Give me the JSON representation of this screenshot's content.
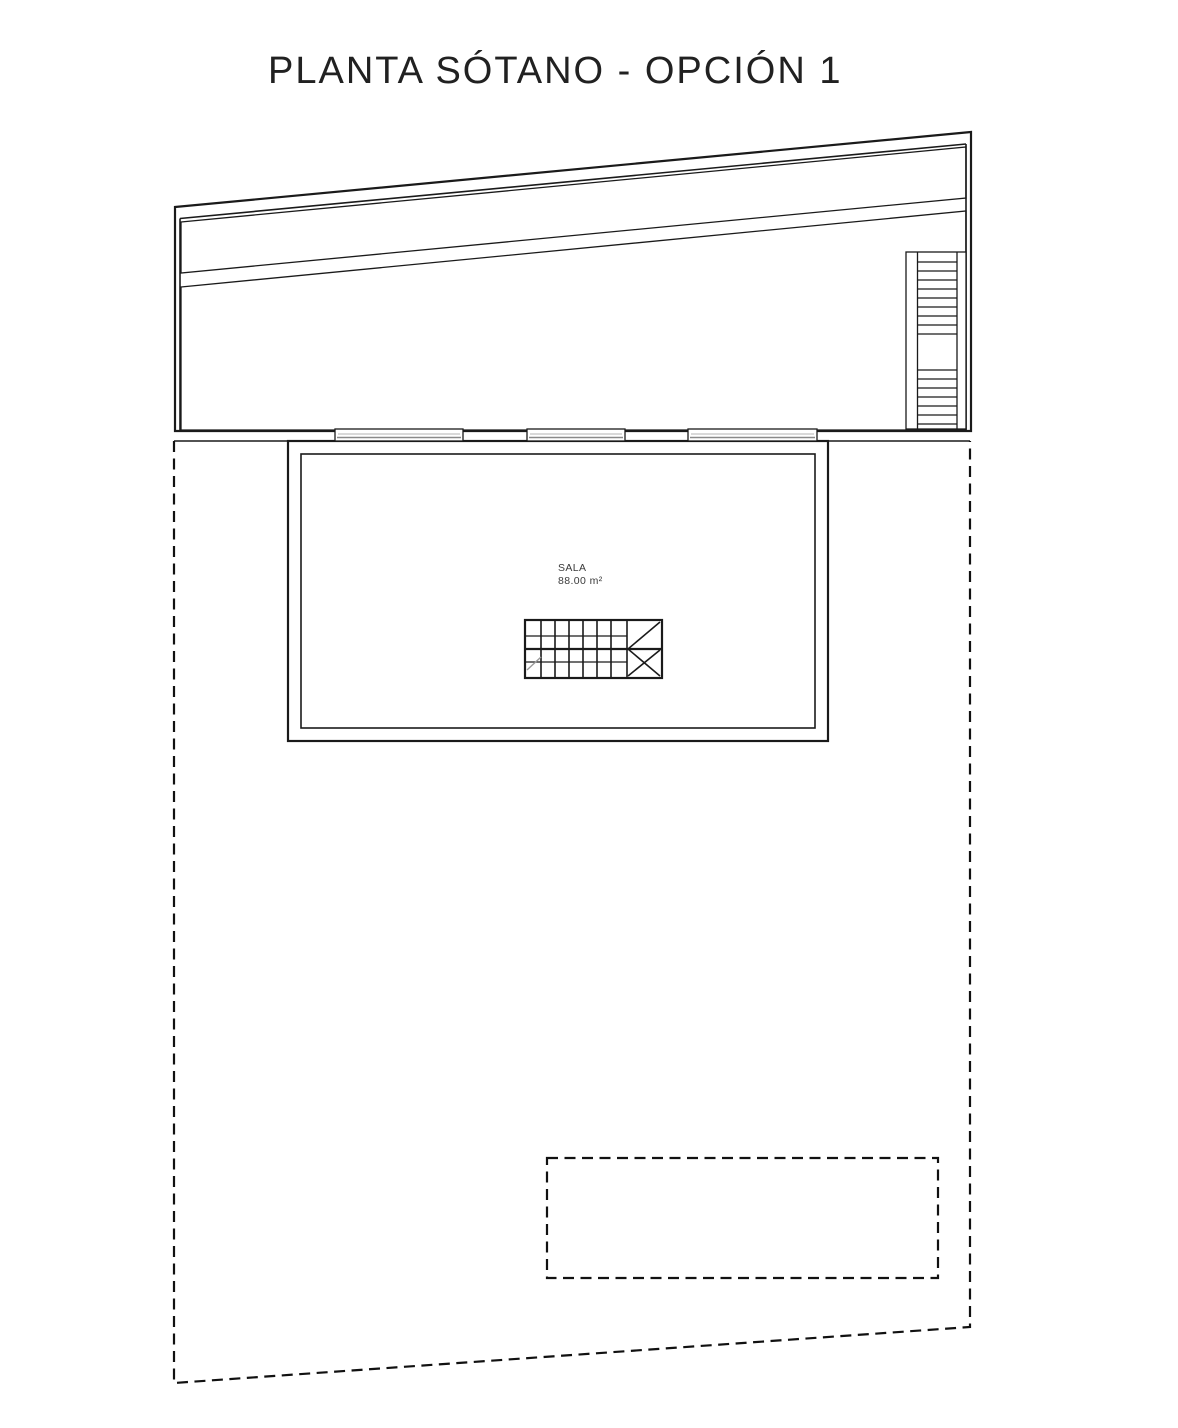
{
  "page": {
    "title": "PLANTA SÓTANO - OPCIÓN 1"
  },
  "room": {
    "name": "SALA",
    "area": "88.00 m²"
  },
  "colors": {
    "grass": "#34b51a",
    "soil": "#9d9256"
  },
  "drawing": {
    "plot_boundary_style": "dashed",
    "pool_outline_style": "dashed",
    "exterior_stair_upper_treads": 8,
    "exterior_stair_lower_treads": 6,
    "window_count": 3
  }
}
